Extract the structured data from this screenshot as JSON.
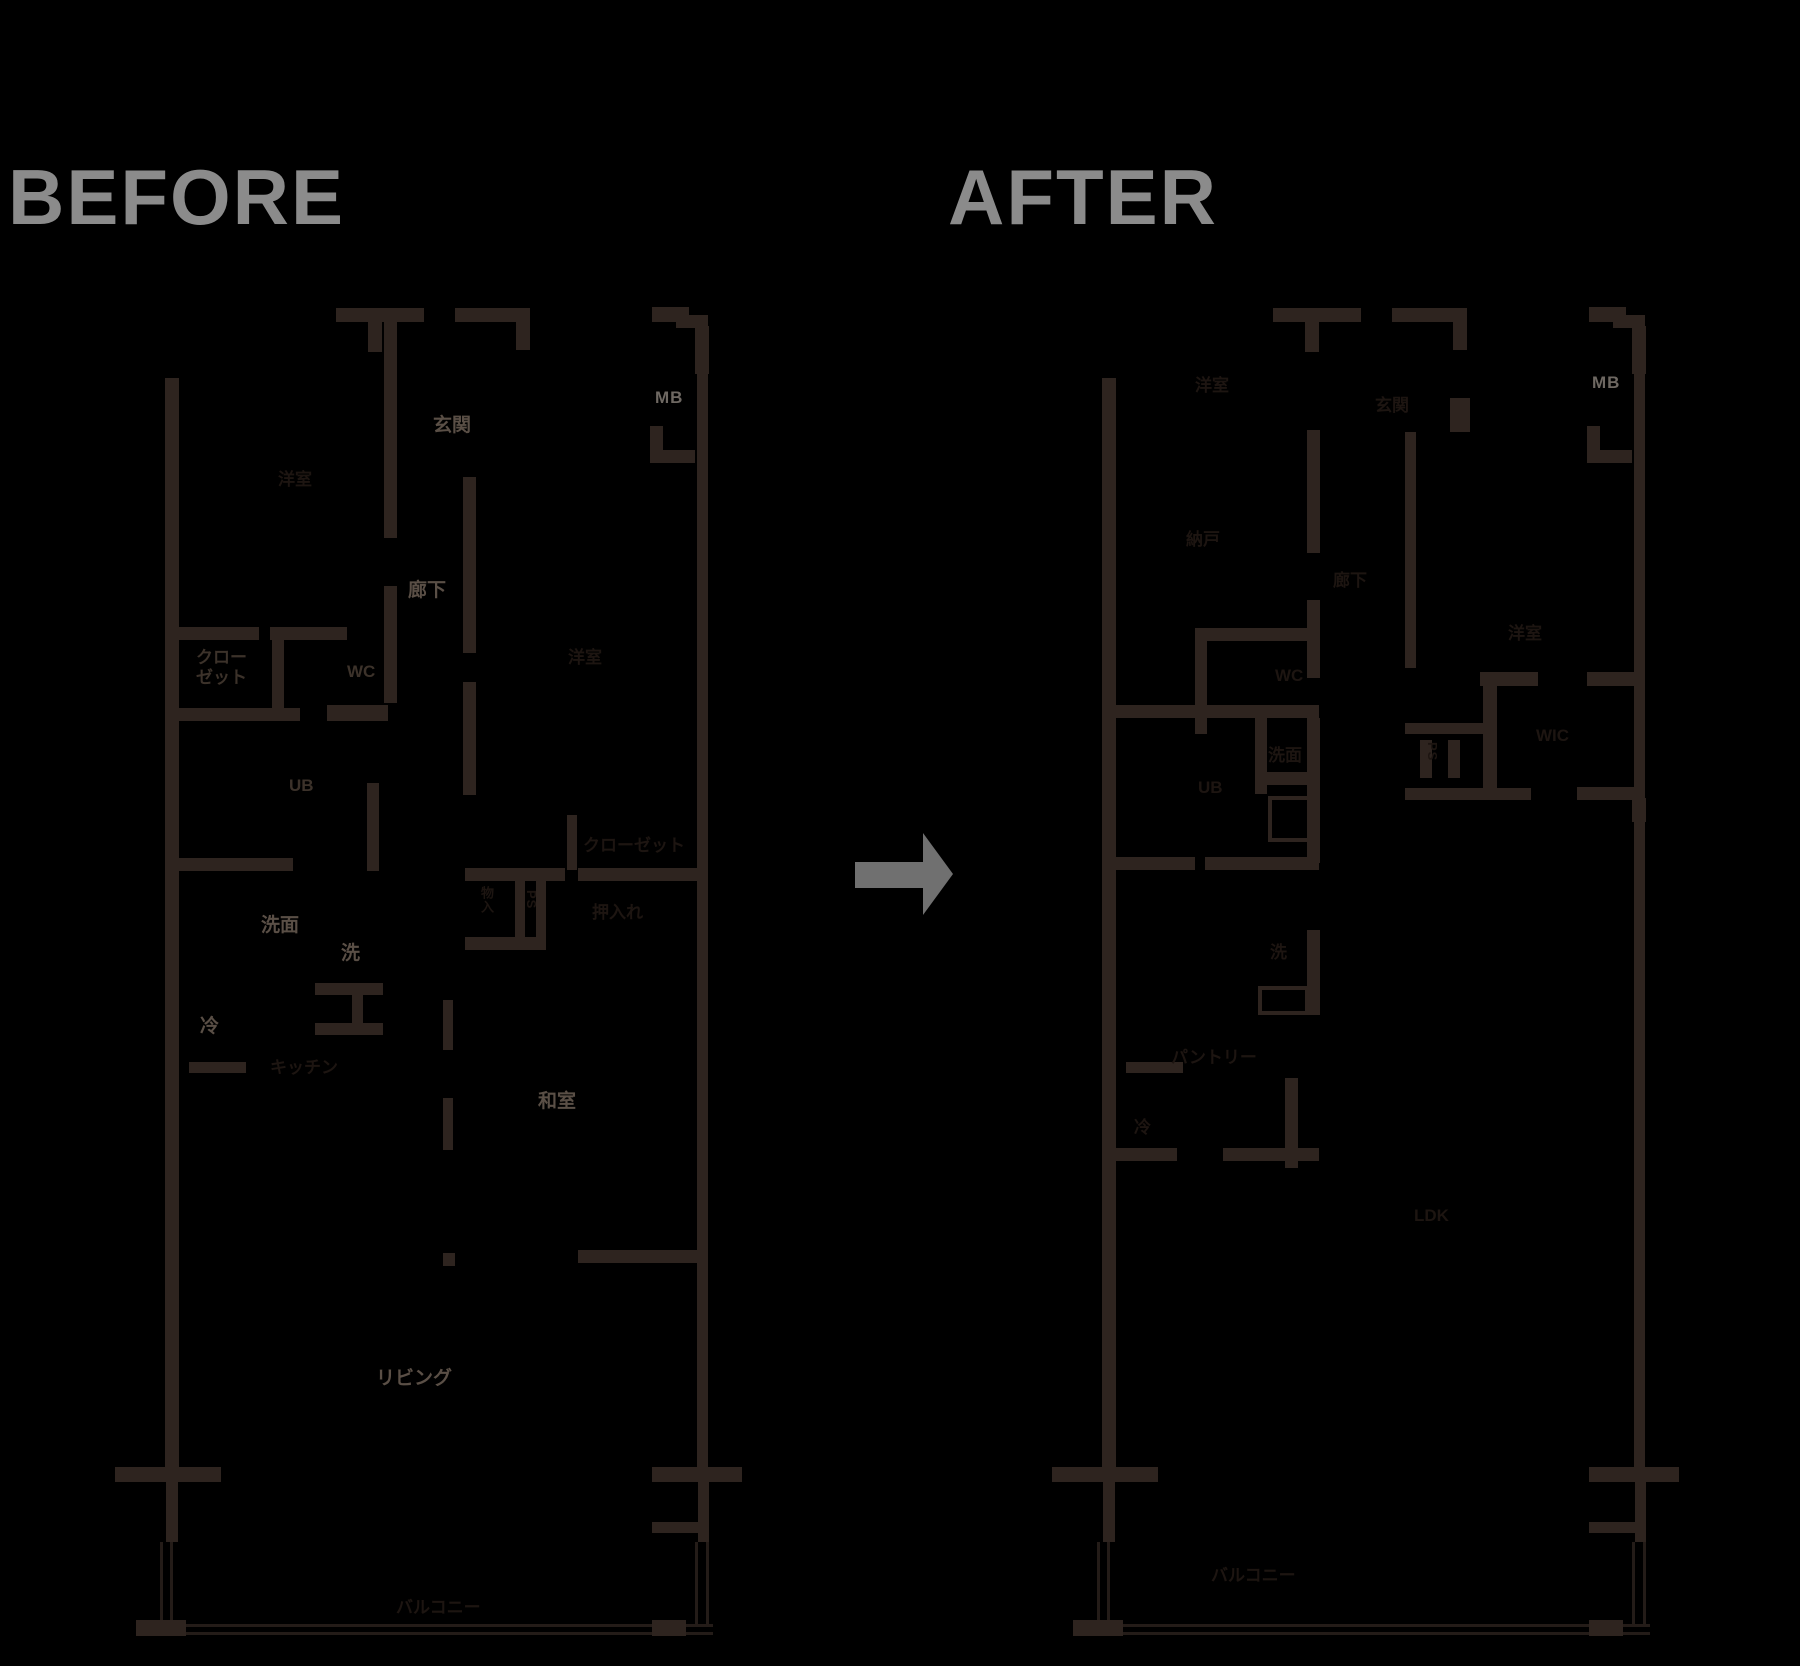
{
  "titles": {
    "before": "BEFORE",
    "after": "AFTER"
  },
  "arrow": {
    "name": "right-arrow",
    "color": "#707070"
  },
  "colors": {
    "background": "#000000",
    "wall": "#2e241f",
    "thin_line": "#241c18",
    "title_gray": "#8b8b8b",
    "label_bright": "#5a4f46",
    "label_mid": "#3c322a",
    "label_dark": "#1d1511",
    "label_mb": "#6e6862"
  },
  "before_plan": {
    "name": "floor-plan-before",
    "labels": [
      {
        "id": "genkan",
        "text": "玄関",
        "x": 433,
        "y": 415,
        "tone": "bright",
        "vertical": false
      },
      {
        "id": "rouka",
        "text": "廊下",
        "x": 408,
        "y": 580,
        "tone": "bright",
        "vertical": false
      },
      {
        "id": "mb",
        "text": "MB",
        "x": 655,
        "y": 388,
        "tone": "mb",
        "vertical": false
      },
      {
        "id": "senmen",
        "text": "洗面",
        "x": 261,
        "y": 915,
        "tone": "bright",
        "vertical": false
      },
      {
        "id": "sen",
        "text": "洗",
        "x": 341,
        "y": 943,
        "tone": "bright",
        "vertical": false
      },
      {
        "id": "rei",
        "text": "冷",
        "x": 200,
        "y": 1016,
        "tone": "bright",
        "vertical": false
      },
      {
        "id": "washitsu",
        "text": "和室",
        "x": 538,
        "y": 1091,
        "tone": "bright",
        "vertical": false
      },
      {
        "id": "living",
        "text": "リビング",
        "x": 376,
        "y": 1368,
        "tone": "bright",
        "vertical": false
      },
      {
        "id": "closet1",
        "text": "クロー\nゼット",
        "x": 196,
        "y": 648,
        "tone": "mid",
        "vertical": false
      },
      {
        "id": "wc",
        "text": "WC",
        "x": 347,
        "y": 662,
        "tone": "mid",
        "vertical": false
      },
      {
        "id": "ub",
        "text": "UB",
        "x": 289,
        "y": 776,
        "tone": "mid",
        "vertical": false
      },
      {
        "id": "youshitsu-left",
        "text": "洋室",
        "x": 278,
        "y": 470,
        "tone": "dark",
        "vertical": false
      },
      {
        "id": "youshitsu-right",
        "text": "洋室",
        "x": 568,
        "y": 648,
        "tone": "dark",
        "vertical": false
      },
      {
        "id": "kitchen",
        "text": "キッチン",
        "x": 270,
        "y": 1058,
        "tone": "dark",
        "vertical": false
      },
      {
        "id": "closet2",
        "text": "クローゼット",
        "x": 583,
        "y": 836,
        "tone": "dark",
        "vertical": false
      },
      {
        "id": "oshiire",
        "text": "押入れ",
        "x": 592,
        "y": 903,
        "tone": "dark",
        "vertical": false
      },
      {
        "id": "ps",
        "text": "PS",
        "x": 523,
        "y": 890,
        "tone": "dark",
        "vertical": true
      },
      {
        "id": "monoire",
        "text": "物入",
        "x": 478,
        "y": 886,
        "tone": "dark",
        "vertical": true
      },
      {
        "id": "balcony",
        "text": "バルコニー",
        "x": 396,
        "y": 1598,
        "tone": "dark",
        "vertical": false
      }
    ]
  },
  "after_plan": {
    "name": "floor-plan-after",
    "labels": [
      {
        "id": "mb",
        "text": "MB",
        "x": 1592,
        "y": 373,
        "tone": "mb",
        "vertical": false
      },
      {
        "id": "youshitsu-top",
        "text": "洋室",
        "x": 1195,
        "y": 376,
        "tone": "dark",
        "vertical": false
      },
      {
        "id": "nando",
        "text": "納戸",
        "x": 1186,
        "y": 530,
        "tone": "dark",
        "vertical": false
      },
      {
        "id": "genkan",
        "text": "玄関",
        "x": 1375,
        "y": 396,
        "tone": "dark",
        "vertical": false
      },
      {
        "id": "rouka",
        "text": "廊下",
        "x": 1333,
        "y": 571,
        "tone": "dark",
        "vertical": false
      },
      {
        "id": "wc",
        "text": "WC",
        "x": 1275,
        "y": 666,
        "tone": "dark",
        "vertical": false
      },
      {
        "id": "senmen",
        "text": "洗面",
        "x": 1268,
        "y": 746,
        "tone": "dark",
        "vertical": false
      },
      {
        "id": "ub",
        "text": "UB",
        "x": 1198,
        "y": 778,
        "tone": "dark",
        "vertical": false
      },
      {
        "id": "sen",
        "text": "洗",
        "x": 1270,
        "y": 943,
        "tone": "dark",
        "vertical": false
      },
      {
        "id": "rei",
        "text": "冷",
        "x": 1134,
        "y": 1118,
        "tone": "dark",
        "vertical": false
      },
      {
        "id": "pantry",
        "text": "パントリー",
        "x": 1171,
        "y": 1048,
        "tone": "dark",
        "vertical": false
      },
      {
        "id": "ldk",
        "text": "LDK",
        "x": 1414,
        "y": 1206,
        "tone": "dark",
        "vertical": false
      },
      {
        "id": "youshitsu-right",
        "text": "洋室",
        "x": 1508,
        "y": 624,
        "tone": "dark",
        "vertical": false
      },
      {
        "id": "wic",
        "text": "WIC",
        "x": 1536,
        "y": 726,
        "tone": "dark",
        "vertical": false
      },
      {
        "id": "ps",
        "text": "PS",
        "x": 1424,
        "y": 742,
        "tone": "dark",
        "vertical": true
      },
      {
        "id": "balcony",
        "text": "バルコニー",
        "x": 1211,
        "y": 1566,
        "tone": "dark",
        "vertical": false
      }
    ]
  }
}
